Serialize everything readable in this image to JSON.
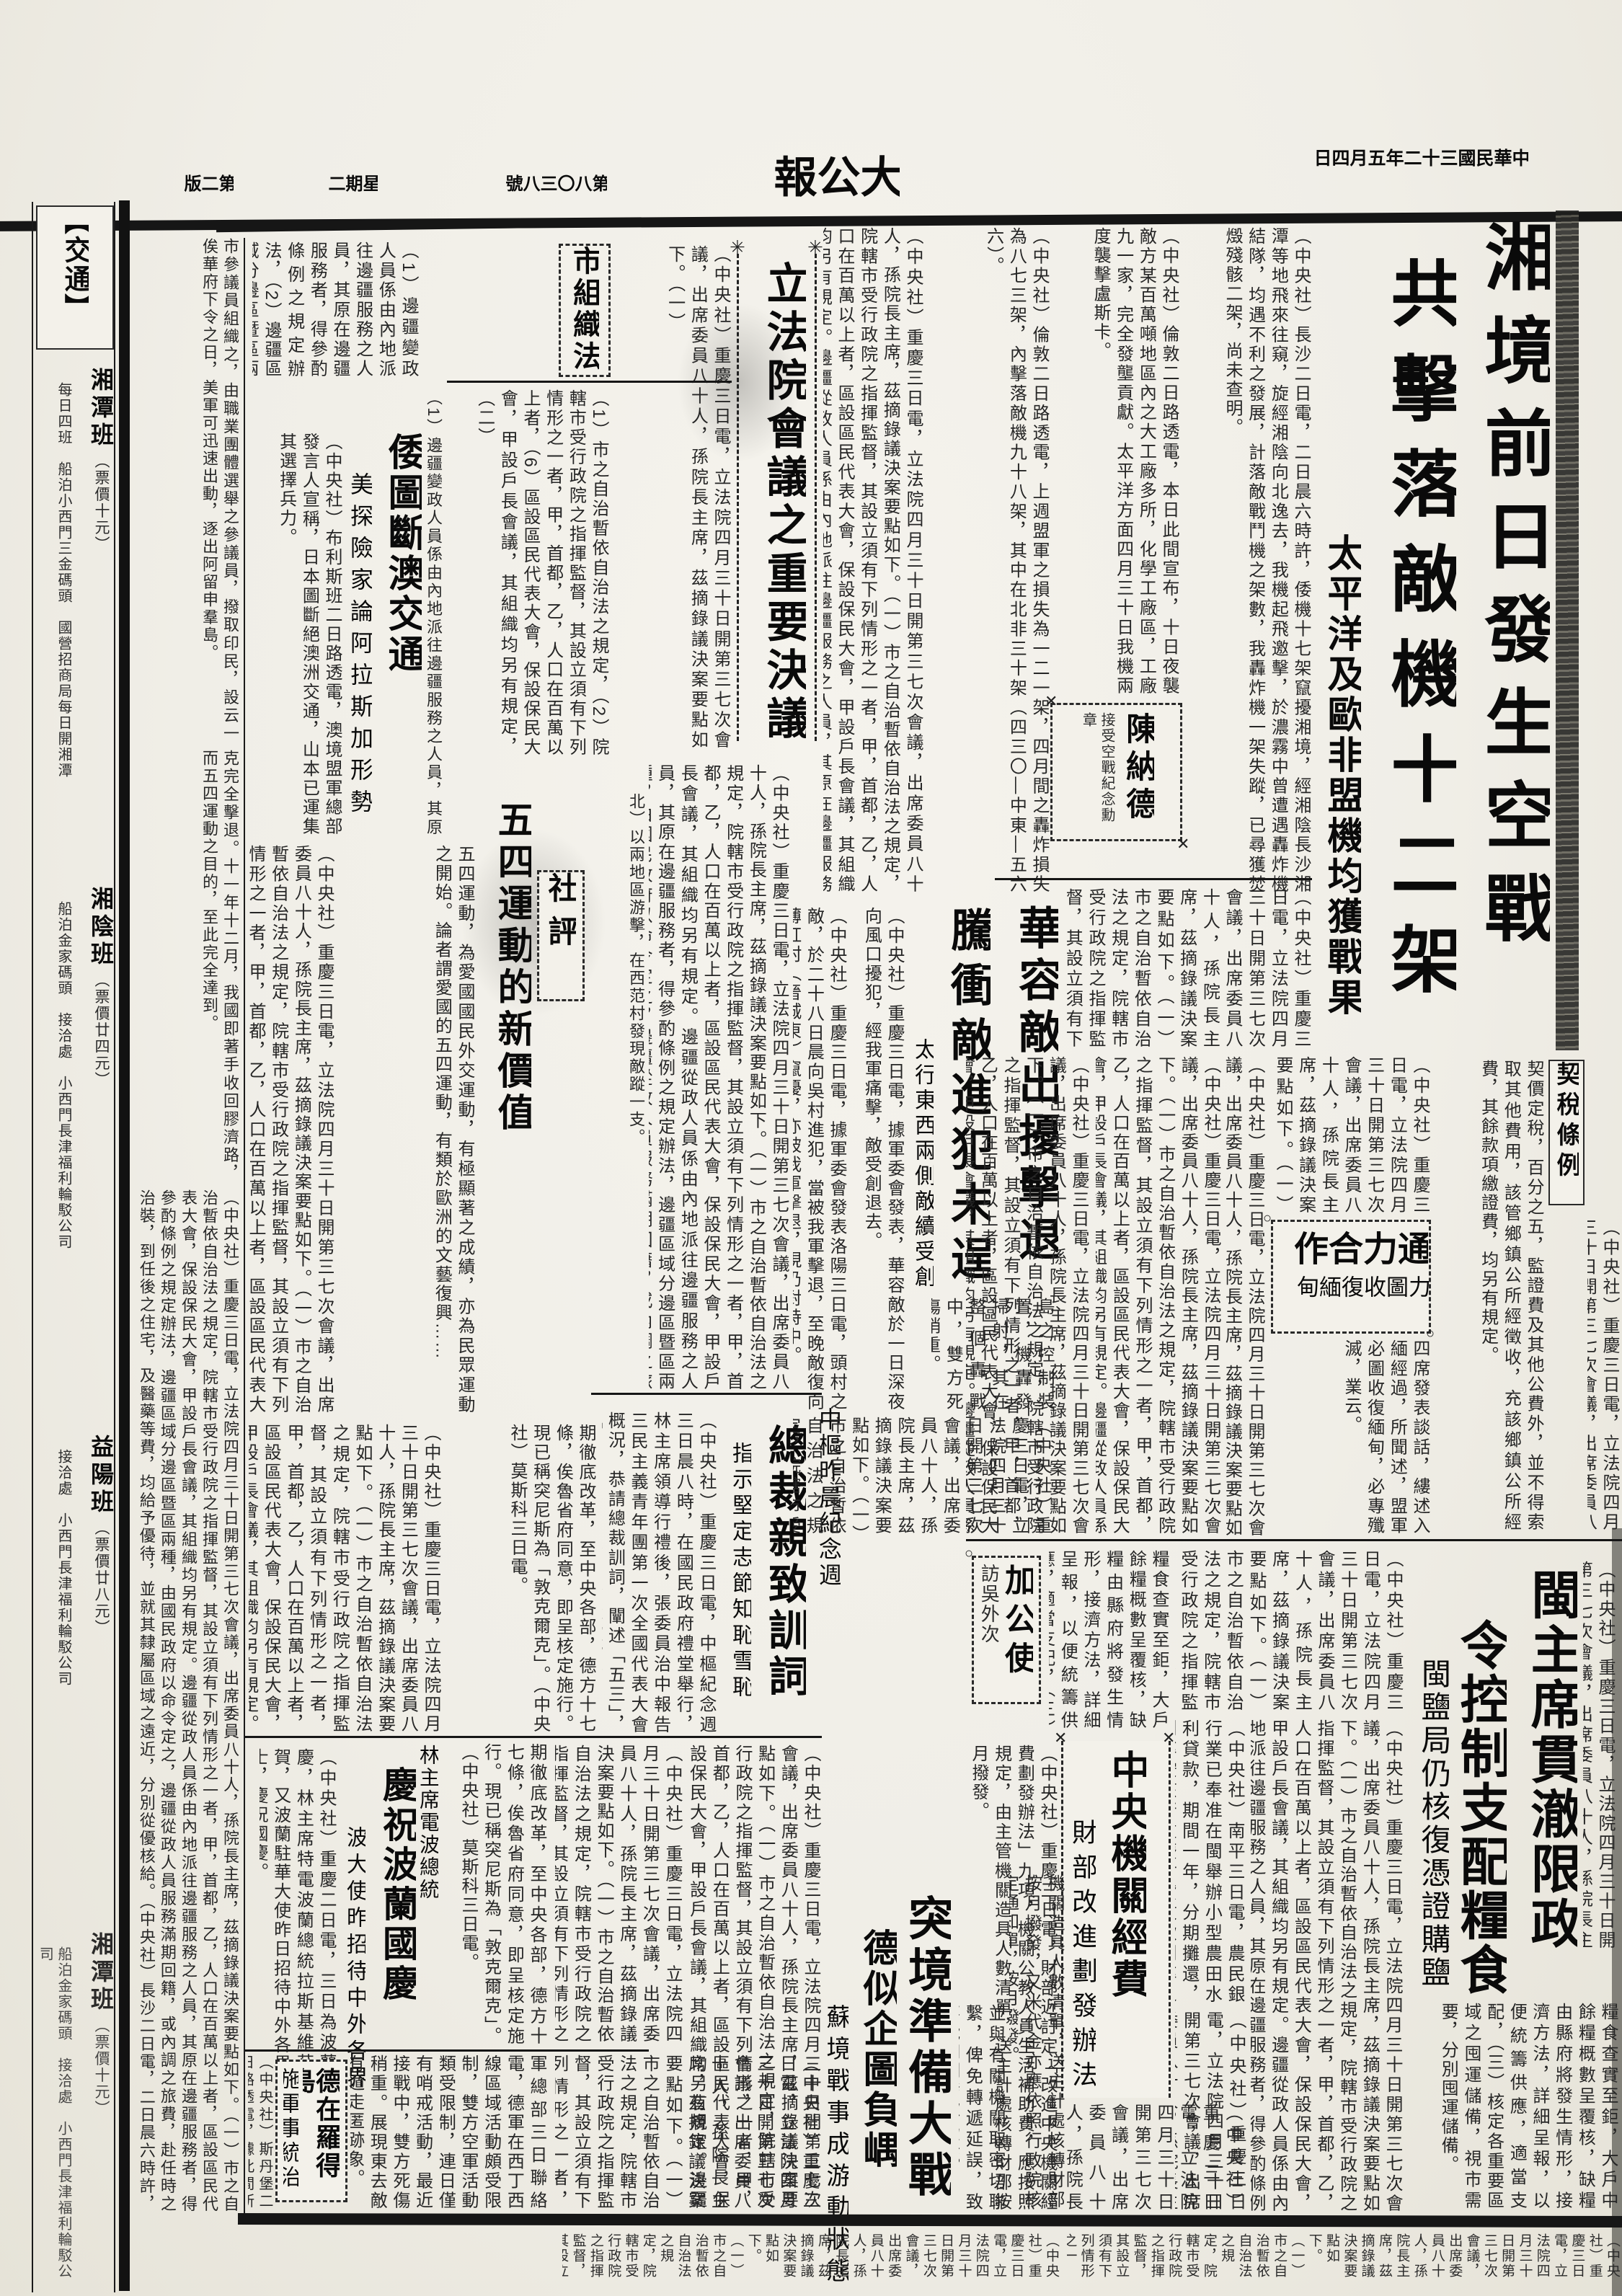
{
  "masthead": {
    "edition": "第二版",
    "weekday": "星期二",
    "issue": "第八〇三八號",
    "title": "大公報",
    "date": "中華民國三十二年五月四日"
  },
  "decor": {
    "star": "✳",
    "cross": "✕",
    "circle": "○",
    "bo": "【",
    "bc": "】"
  },
  "lead": {
    "h1": "湘境前日發生空戰",
    "h2": "共擊落敵機十二架",
    "sub": "太平洋及歐非盟機均獲戰果",
    "body1": "（中央社）長沙二日電，二日晨六時許，倭機十七架竄擾湘境，經湘陰長沙湘潭等地飛來往窺，旋經湘陰向北逸去，我機起飛邀擊，於濃霧中曾遭遇轟炸機結隊，均遇不利之發展，計落敵戰鬥機之架數，我轟炸機一架失蹤，已尋獲焚燬殘骸二架，尚未查明。",
    "body2": "（中央社）倫敦二日路透電，本日此間宣布，十日夜襲敵方某百萬噸地區內之大工廠多所，化學工廠區，工廠九一家，完全發壟貢獻。太平洋方面四月三十日我機兩度襲擊盧斯卡。",
    "body3": "（中央社）倫敦二日路透電，上週盟軍之損失為一二一架，四月間之轟炸損失為八七三架，內擊落敵機九十八架，其中在北非三十架（四三〇—中東—五六六）。"
  },
  "legis": {
    "h": "立法院會議之重要決議",
    "body": "（中央社）重慶三日電，立法院四月三十日開第三七次會議，出席委員八十人，孫院長主席，茲摘錄議決案要點如下。（一）"
  },
  "citylaw": {
    "h": "市組織法",
    "body": "（1）市之自治暫依自治法之規定，（2）院轄市受行政院之指揮監督，其設立須有下列情形之一者，甲，首都，乙，人口在百萬以上者，（6）區設區民代表大會，保設保民大會，甲設戶長會議，其組織均另有規定，（二）"
  },
  "frontier": {
    "body": "（1）邊疆變政人員係由內地派往邊疆服務之人員，其原在邊疆服務者，得參酌條例之規定辦法，（2）邊疆區域分邊區暨區兩種，由國民政府以命令定之，（3）邊疆從政人員服務滿期回籍，或內調之旅費，赴任時之治裝，到任後之住宅，及醫藥等費，均給予優待，並就其隸屬區域之遠近，分別從優核給，及未赴任隨帶眷屬之往返旅費。"
  },
  "aus": {
    "h": "倭圖斷澳交通",
    "sub": "美探險家論阿拉斯加形勢",
    "body": "（中央社）布利斯班二日路透電，澳境盟軍總部發言人宣稱，日本圖斷絕澳洲交通，山本已運集其選擇兵力。"
  },
  "edi": {
    "label": "社評",
    "h": "五四運動的新價值",
    "body": "五四運動，為愛國國民外交運動，有極顯著之成績，亦為民眾運動之開始。論者謂愛國的五四運動，有類於歐洲的文藝復興……",
    "body2": "克完全擊退。十一年十二月，我國即著手收回膠濟路，而五四運動之目的，至此完全達到。"
  },
  "war": {
    "h1": "華容敵出擾擊退",
    "h2": "騰衝敵進犯未逞",
    "sub": "太行東西兩側敵續受創",
    "body": "（中央社）重慶三日電，據軍委會發表，華容敵於一日深夜向風口擾犯，經我軍痛擊，敵受創退去。",
    "body2": "（中央社）重慶三日電，據軍委會發表洛陽三日電，頭村之敵，於二十八日晨向吳村進犯，當被我軍擊退，至晚敵復向薄紅村（晉城東）竄擾，亦被我軍擊退，現仍對峙中。",
    "frag": "北）以兩地區游擊，在西范村發現敵蹤一支。"
  },
  "chen": {
    "h": "陳納德",
    "sub": "接受空戰紀念勳章"
  },
  "coop": {
    "h": "通力合作",
    "sub": "力圖收復緬甸",
    "body": "四席發表談話，縷述入緬經過，所聞述，盟軍必圖收復緬甸，必專殲滅，業云。"
  },
  "tax": {
    "h": "契稅條例",
    "body": "契價定稅，百分之五，監證費及其他公費外，並不得索取其他費用，該管鄉鎮公所經徵收，充該鄉鎮公所經費，其餘款項繳證費，均另有規定。"
  },
  "pres": {
    "top": "中樞昨晨紀念週",
    "h": "總裁親致訓詞",
    "sub": "指示堅定志節知恥雪恥",
    "body": "（中央社）重慶三日電，中樞紀念週三日晨八時，在國民政府禮堂舉行，林主席領導行禮後，張委員治中報告三民主義青年團第一次全國代表大會概況，恭請總裁訓詞，闡述「五三」，「五四」對國家民族及抗戰之關係，並指示「堅定志節」，「知恥雪恥」，旋即禮成。"
  },
  "min": {
    "h1": "閩主席貫澈限政",
    "h2": "令控制支配糧食",
    "sub": "閩鹽局仍核復憑證購鹽",
    "body": "糧食查實至鉅，大戶中餘糧概數呈覆核，缺糧由縣府將發生情形，接濟方法，詳細呈報，以便統籌供應，適當支配，（三）核定各重要區域之囤運儲備，視市需要，分別囤運儲備。"
  },
  "canada": {
    "h": "加公使",
    "sub": "訪吳外次"
  },
  "grain": {
    "body": "糧食查實至鉅，大戶餘糧概數呈覆核，缺糧由縣府將發生情形，接濟方法，詳細呈報，以便統籌供應，適當支配，（三）核定各重要區域之囤運儲備，視市面需要，分別囤運儲備。"
  },
  "funds": {
    "h": "中央機關經費",
    "sub": "財部改進劃發辦法",
    "body": "（中央社）重慶三日電，財部近訂定「改進中央機關經費劃發辦法」九項，機關公教人員生活補助費，應按照規定，由主管機關造具人數清單，送主計處核轉財部按月撥發。",
    "body2": "機關造具人數清單，送主計處核轉財部按月撥發，又米代金亦應依照行政院核定通知單，按月撥發。",
    "body3": "並與有關機關取密切聯繫，俾免轉遞延誤，致不能如期發款為要。"
  },
  "farm": {
    "body": "（中央社）南平三日電，農民銀行業已奉准在閩舉辦小型農田水利貸款，期間一年，分期攤還，利率按該行重慶村貸放款利率之規定辦理。"
  },
  "tun": {
    "h1": "突境準備大戰",
    "h2": "德似企圖負嵎",
    "sub": "蘇境戰事成游動狀態"
  },
  "pol": {
    "h": "慶祝波蘭國慶",
    "r": "林主席電波總統",
    "sub": "波大使昨招待中外各界",
    "body": "（中央社）重慶二日電，三日為波蘭國慶，林主席特電波蘭總統拉斯基維茲致賀，又波蘭駐華大使昨日招待中外各界人士，慶祝國慶。"
  },
  "rho": {
    "h1": "德在羅得島",
    "h2": "施軍事統治",
    "body": "（中央社）斯丹堡二日路透電，據此間所得消息，德軍在羅得島已施行軍事統治。",
    "body2": "軍總部三日聯絡電，德軍在西丁西線區域活動頗受限制，雙方空軍活動類受限制，連日僅有哨戒活動，最近接戰中，雙方死傷稍重。展現東去敵有遁走匿跡象。"
  },
  "misc": {
    "frag1": "期徹底改革，至中央各部，德方十七條，俟魯省府同意，即呈核定施行。現已稱突尼斯為「敦克爾克」。（中央社）莫斯科三日電。",
    "frag2": "島之控制裝置，機轟發掃射，其在整個轟戰中，雙方死傷稍重。"
  },
  "council": {
    "body": "市參議員組織之，由職業團體選舉之參議員，撥取印民，設云一俟華府下令之日，美軍可迅速出動，逐出阿留申羣島。"
  },
  "ads": {
    "header": "交通",
    "items": [
      {
        "name": "湘潭班",
        "fare": "（票價十元）",
        "note": "每日四班　船泊小西門三金碼頭　國營招商局每日開湘潭"
      },
      {
        "name": "湘陰班",
        "fare": "（票價廿四元）",
        "note": "船泊金家碼頭　接洽處　小西門長津福利輪駁公司"
      },
      {
        "name": "益陽班",
        "fare": "（票價廿八元）",
        "note": "接洽處　小西門長津福利輪駁公司"
      }
    ]
  },
  "filler": {
    "long": "（中央社）重慶三日電，立法院四月三十日開第三七次會議，出席委員八十人，孫院長主席，茲摘錄議決案要點如下。（一）市之自治暫依自治法之規定，院轄市受行政院之指揮監督，其設立須有下列情形之一者，甲，首都，乙，人口在百萬以上者，區設區民代表大會，保設保民大會，甲設戶長會議，其組織均另有規定。邊疆從政人員係由內地派往邊疆服務之人員，其原在邊疆服務者，得參酌條例之規定辦法，邊疆區域分邊區暨區兩種，由國民政府以命令定之，邊疆從政人員服務滿期回籍，或內調之旅費，赴任時之治裝，到任後之住宅，及醫藥等費，均給予優待，並就其隸屬區域之遠近，分別從優核給。（中央社）長沙二日電，二日晨六時許，倭機十七架竄擾湘境，經湘陰長沙湘潭等地飛來往窺，旋經湘陰向北逸去，我機起飛邀擊，於濃霧中曾遭遇轟炸機結隊，均遇不利之發展，我轟炸機一架失蹤，已尋獲焚燬殘骸二架。（中央社）重慶三日電，財部近訂定改進中央機關經費劃發辦法九項，機關公教人員生活補助費，應按照規定，由主管機關造具人數清單，送主計處核轉財部按月撥發，又米代金亦應依照行政院核定通知單，按月撥發，並與有關機關取密切聯繫，俾免轉遞延誤，致不能如期發款。（中央社）南平三日電，農民銀行業已奉准在閩舉辦小型農田水利貸款，期間一年，分期攤還，利率按該行重慶村貸放款利率之規定辦理。契價定稅，監證費及其他公費外，並不得索取其他費用，該管鄉鎮公所經徵收，充該鄉鎮公所經費。軍總部三日聯絡電，德軍在西丁西線區域活動頗受限制，雙方空軍活動連日僅有哨戒，最近接戰中雙方死傷稍重。市參議員由職業團體選舉之，設云一俟華府下令之日，美軍可迅速出動，逐出阿留申羣島。"
  }
}
